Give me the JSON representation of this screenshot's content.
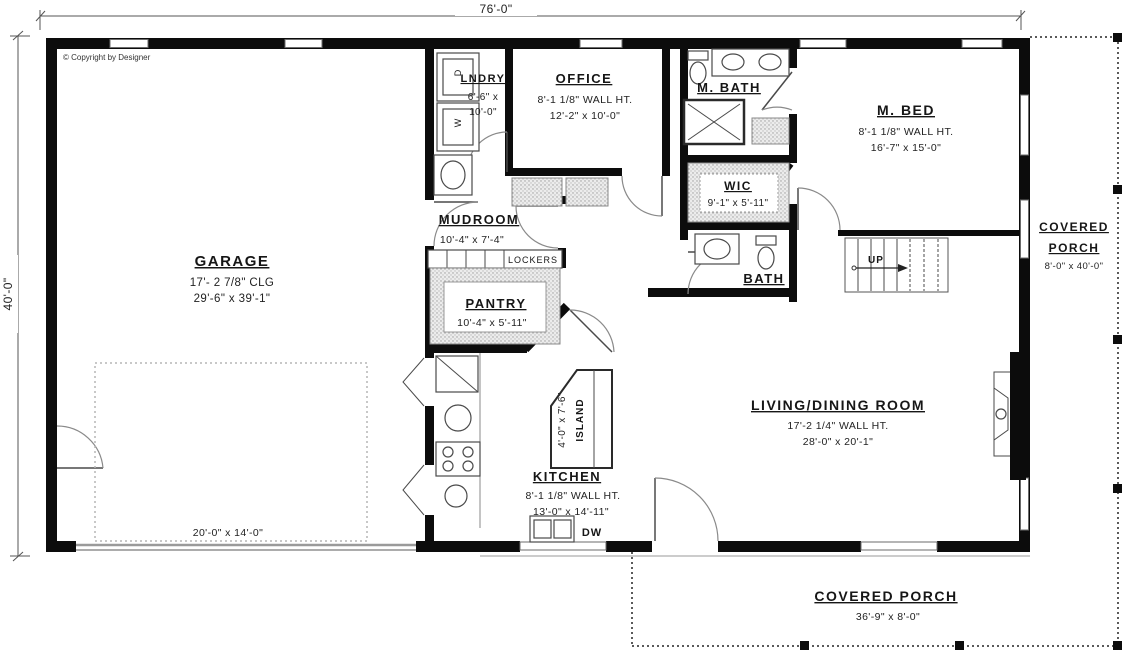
{
  "copyright": "© Copyright by Designer",
  "dimensions": {
    "overall_width": "76'-0\"",
    "overall_height": "40'-0\""
  },
  "rooms": {
    "garage": {
      "name": "GARAGE",
      "line1": "17'- 2 7/8\" CLG",
      "line2": "29'-6\" x 39'-1\""
    },
    "garage_door": {
      "size": "20'-0\" x 14'-0\""
    },
    "lndry": {
      "name": "LNDRY",
      "line1": "6'-6\" x",
      "line2": "10'-0\""
    },
    "office": {
      "name": "OFFICE",
      "line1": "8'-1 1/8\" WALL HT.",
      "line2": "12'-2\" x 10'-0\""
    },
    "m_bath": {
      "name": "M. BATH"
    },
    "m_bed": {
      "name": "M. BED",
      "line1": "8'-1 1/8\" WALL HT.",
      "line2": "16'-7\" x 15'-0\""
    },
    "wic": {
      "name": "WIC",
      "line1": "9'-1\" x 5'-11\""
    },
    "mudroom": {
      "name": "MUDROOM",
      "line1": "10'-4\" x 7'-4\""
    },
    "pantry": {
      "name": "PANTRY",
      "line1": "10'-4\" x 5'-11\""
    },
    "bath": {
      "name": "BATH"
    },
    "kitchen": {
      "name": "KITCHEN",
      "line1": "8'-1 1/8\" WALL HT.",
      "line2": "13'-0\" x 14'-11\""
    },
    "island": {
      "line1": "4'-0\" x 7'-6\"",
      "line2": "ISLAND"
    },
    "living": {
      "name": "LIVING/DINING ROOM",
      "line1": "17'-2 1/4\" WALL HT.",
      "line2": "28'-0\" x 20'-1\""
    },
    "porch_right": {
      "name_line1": "COVERED",
      "name_line2": "PORCH",
      "line1": "8'-0\" x 40'-0\""
    },
    "porch_bottom": {
      "name": "COVERED PORCH",
      "line1": "36'-9\" x 8'-0\""
    }
  },
  "fixtures": {
    "washer": "W",
    "dryer": "D",
    "dishwasher": "DW",
    "lockers": "LOCKERS",
    "stairs_direction": "UP"
  }
}
